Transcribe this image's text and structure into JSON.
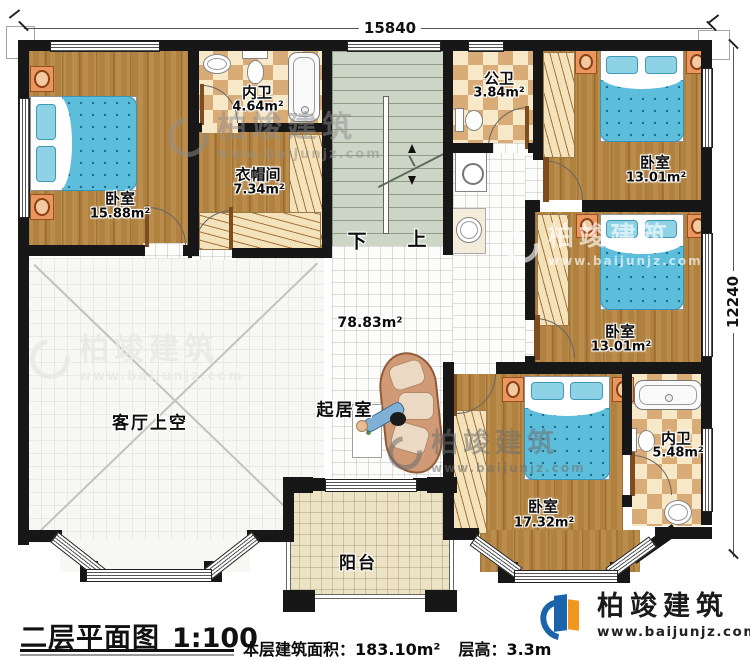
{
  "plan": {
    "dimensions": {
      "width_mm": "15840",
      "height_mm": "12240"
    },
    "stairs": {
      "down_label": "下",
      "up_label": "上"
    },
    "hall_area": "78.83m²",
    "rooms": {
      "bedroom_top_left": {
        "name": "卧室",
        "area": "15.88m²"
      },
      "ensuite_top": {
        "name": "内卫",
        "area": "4.64m²"
      },
      "cloakroom": {
        "name": "衣帽间",
        "area": "7.34m²"
      },
      "public_bath": {
        "name": "公卫",
        "area": "3.84m²"
      },
      "bedroom_top_right": {
        "name": "卧室",
        "area": "13.01m²"
      },
      "bedroom_mid_right": {
        "name": "卧室",
        "area": "13.01m²"
      },
      "bedroom_bottom": {
        "name": "卧室",
        "area": "17.32m²"
      },
      "ensuite_bottom": {
        "name": "内卫",
        "area": "5.48m²"
      },
      "family_room": {
        "name": "起居室"
      },
      "living_void": {
        "name": "客厅上空"
      },
      "balcony": {
        "name": "阳台"
      }
    }
  },
  "footer": {
    "title": "二层平面图",
    "scale": "1:100",
    "area_text": "本层建筑面积：183.10m²",
    "height_text": "层高：3.3m"
  },
  "brand": {
    "name": "柏竣建筑",
    "website": "www.baijunjz.com"
  },
  "watermark": {
    "name": "柏竣建筑",
    "website": "www.baijunjz.com"
  },
  "colors": {
    "wall": "#171717",
    "wood": "#b1813f",
    "tile_tan": "#d9ab77",
    "tile_cream": "#f7e9c8",
    "bed_blue": "#5cbeda",
    "accent_orange": "#f2971e",
    "brand_blue": "#1b63ab"
  }
}
